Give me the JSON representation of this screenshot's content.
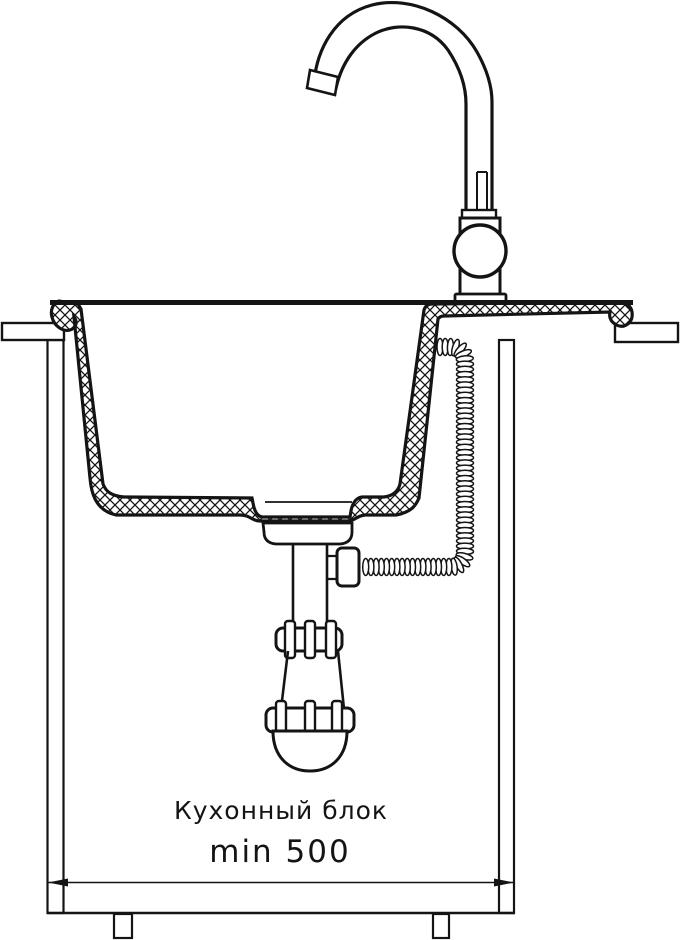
{
  "diagram": {
    "background": "#ffffff",
    "line_color": "#141414",
    "labels": {
      "cabinet_block": "Кухонный блок",
      "min_width": "min 500"
    }
  }
}
